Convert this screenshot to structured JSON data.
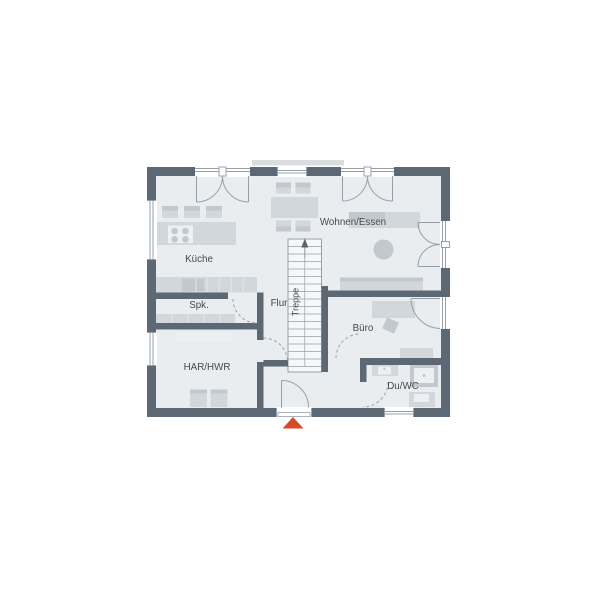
{
  "floorplan": {
    "rooms": [
      {
        "id": "kueche",
        "label": "Küche"
      },
      {
        "id": "spk",
        "label": "Spk."
      },
      {
        "id": "flur",
        "label": "Flur"
      },
      {
        "id": "treppe",
        "label": "Treppe"
      },
      {
        "id": "wohnen_essen",
        "label": "Wohnen/Essen"
      },
      {
        "id": "buero",
        "label": "Büro"
      },
      {
        "id": "har_hwr",
        "label": "HAR/HWR"
      },
      {
        "id": "du_wc",
        "label": "Du/WC"
      }
    ],
    "colors": {
      "wall": "#5c6874",
      "floor": "#e9edf0",
      "furniture": "#d2d7db",
      "furniture-dark": "#c2c8cd",
      "furniture-light": "#edf0f2",
      "stair-fill": "#f5f7f8",
      "line": "#97a0a8",
      "sill": "#d9dde0",
      "text": "#46494d",
      "accent": "#d54b28"
    }
  }
}
